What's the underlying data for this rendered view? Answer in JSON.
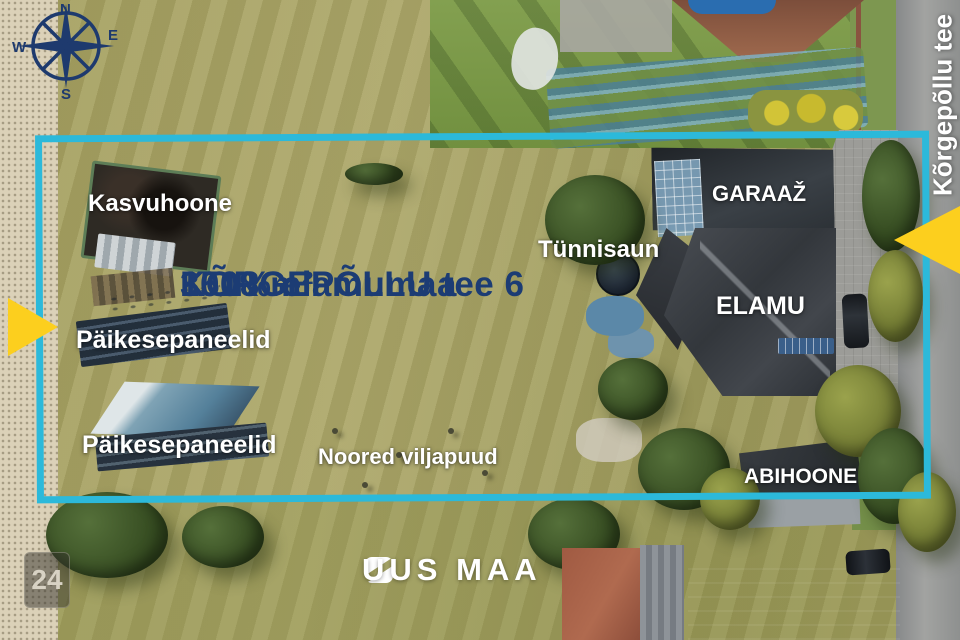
{
  "compass": {
    "north": "N",
    "east": "E",
    "south": "S",
    "west": "W"
  },
  "street_sign": {
    "vertical_label": "Kõrgepõllu tee"
  },
  "property": {
    "title": "KÕRGEPÕLLU tee 6",
    "area": "3518 m²",
    "zoning": "100% elamumaa"
  },
  "labels": {
    "greenhouse": "Kasvuhoone",
    "solar_panels": "Päikesepaneelid",
    "sauna": "Tünnisaun",
    "garage": "GARAAŽ",
    "house": "ELAMU",
    "outbuilding": "ABIHOONE",
    "orchard": "Noored viljapuud"
  },
  "branding": {
    "logo_text": "UUS MAA"
  },
  "badge": {
    "number": "24"
  },
  "colors": {
    "plot_border_teal": "#2cb9da",
    "arrow_yellow": "#fccf1e",
    "title_navy": "#1c3c74",
    "label_white": "#ffffff"
  }
}
